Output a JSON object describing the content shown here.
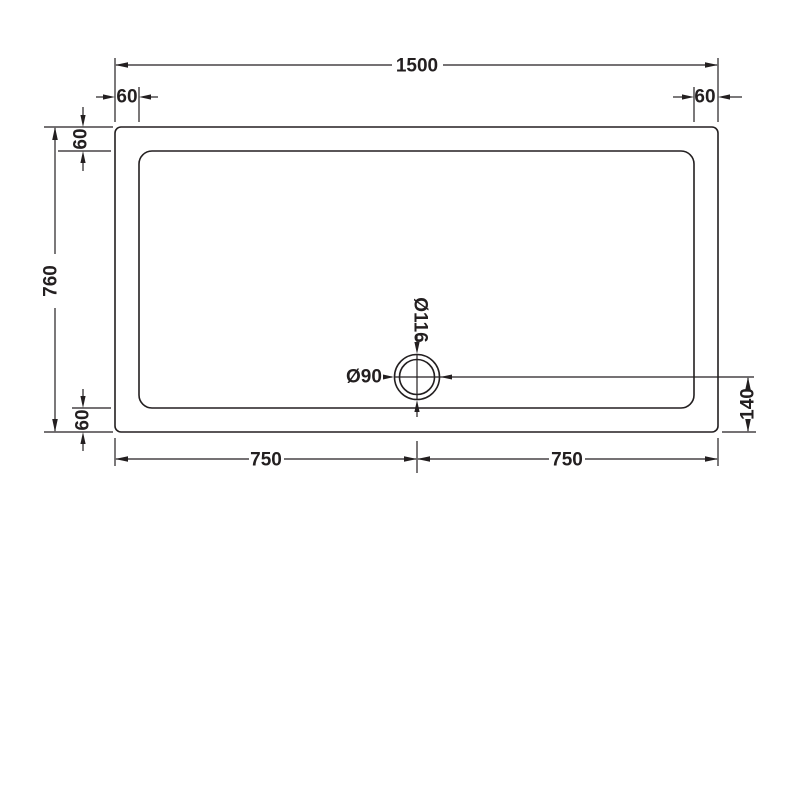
{
  "labels": {
    "overall_width": "1500",
    "overall_depth": "760",
    "rim_top_left": "60",
    "rim_top_right": "60",
    "rim_left_top": "60",
    "rim_left_bottom": "60",
    "bottom_left_half": "750",
    "bottom_right_half": "750",
    "waste_centre_to_edge": "140",
    "waste_outer_diameter": "Ø116",
    "waste_inner_diameter": "Ø90"
  },
  "colors": {
    "line": "#231f20",
    "background": "#ffffff"
  }
}
